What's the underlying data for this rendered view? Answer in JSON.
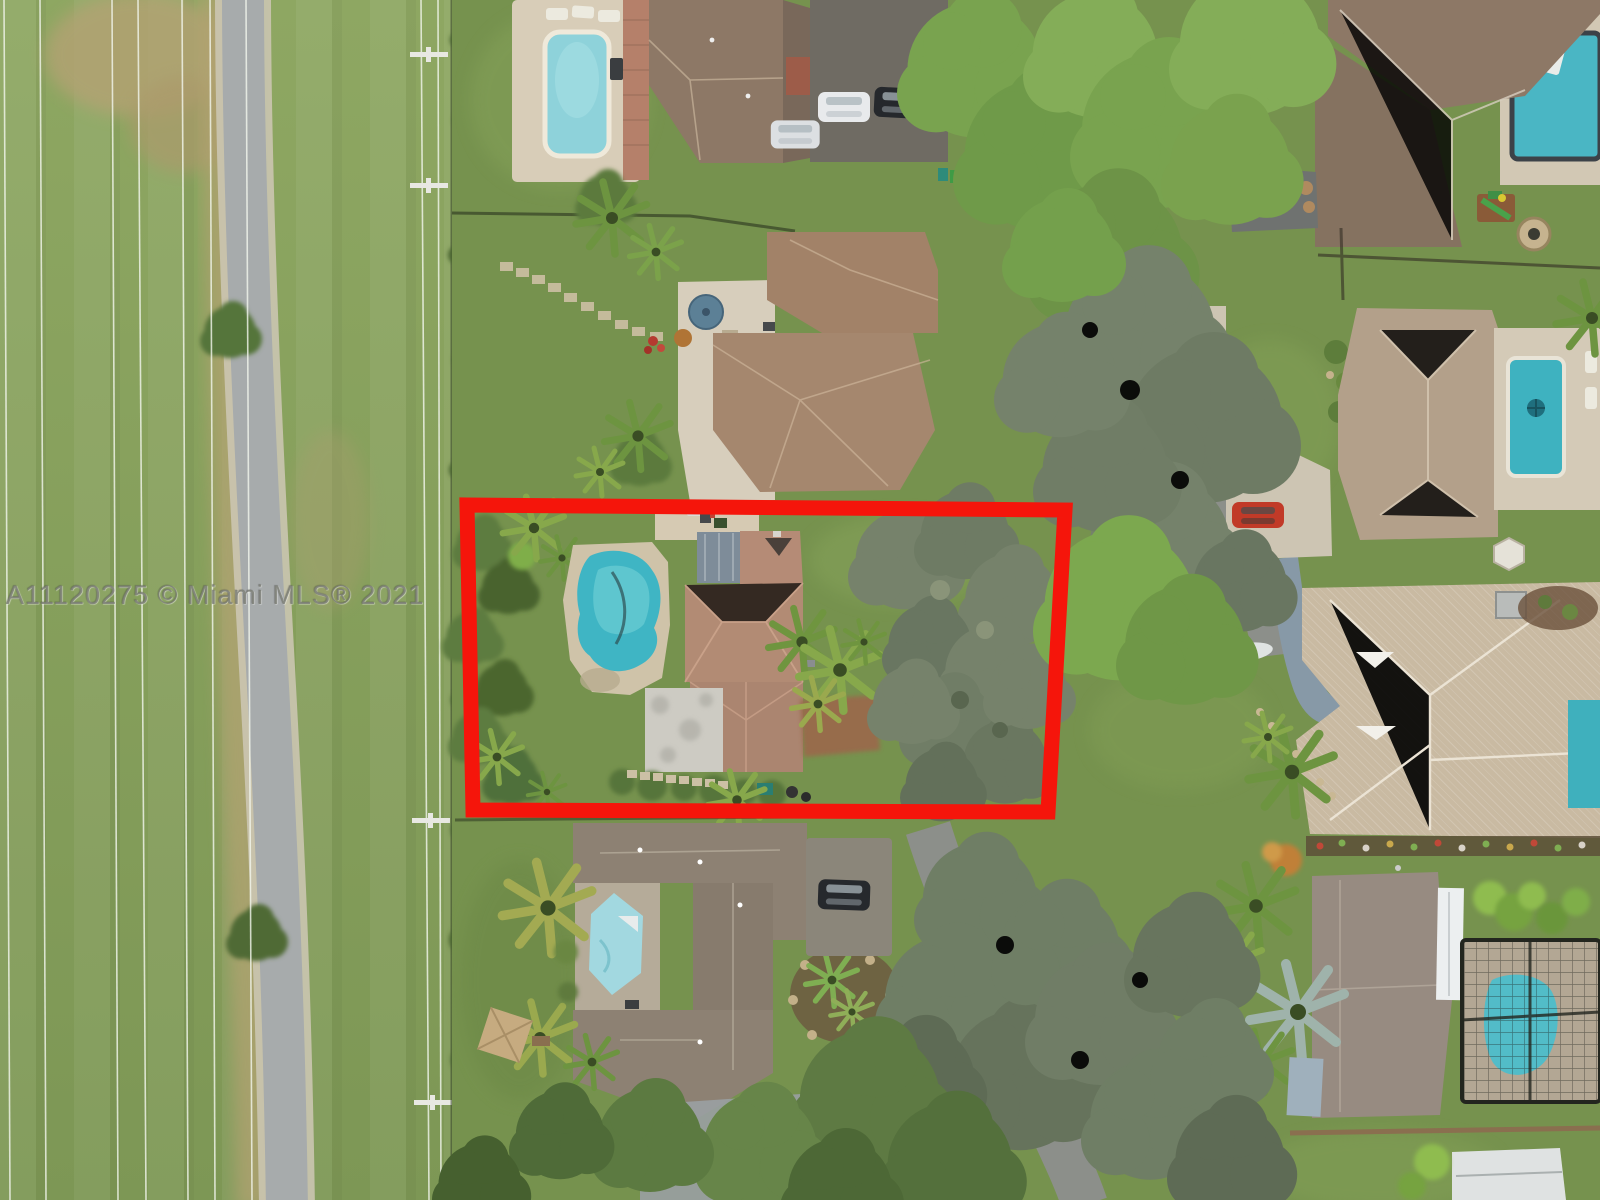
{
  "watermark": {
    "text": "A11120275 © Miami MLS® 2021"
  },
  "colors": {
    "highlight_red": "#f5150b",
    "field_green": "#8aa25e",
    "lawn_green": "#76924e",
    "trail_gray": "#a8abac",
    "pool_teal": "#3fb5c4",
    "pool_light": "#9fd6de",
    "paver_tan": "#d6cab3",
    "roof_terracotta": "#b58b76",
    "roof_brown": "#8d7866",
    "roof_gray_brown": "#8d8173",
    "roof_beige": "#c9baa2",
    "roof_mauve": "#978b81",
    "watermark_gray": "#74776e"
  }
}
